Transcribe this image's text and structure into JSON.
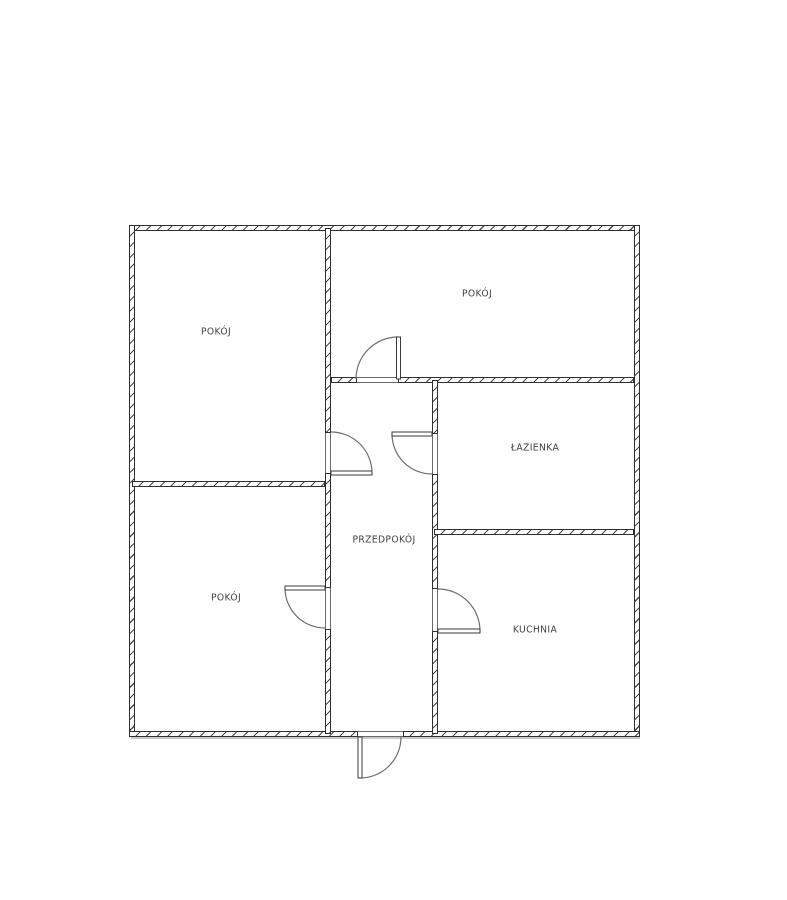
{
  "plan": {
    "kind": "apartment-floor-plan",
    "rooms": [
      {
        "id": "pokoj-top-left",
        "label": "POKÓJ"
      },
      {
        "id": "pokoj-top-right",
        "label": "POKÓJ"
      },
      {
        "id": "lazienka",
        "label": "ŁAZIENKA"
      },
      {
        "id": "przedpokoj",
        "label": "PRZEDPOKÓJ"
      },
      {
        "id": "pokoj-bottom-left",
        "label": "POKÓJ"
      },
      {
        "id": "kuchnia",
        "label": "KUCHNIA"
      }
    ],
    "colors": {
      "background": "#ffffff",
      "wall_line": "#2f2f2f",
      "wall_hatch": "#4a4a4a",
      "door_arc": "#6f6f6f",
      "door_leaf": "#3a3a3a",
      "label_text": "#3f3f3f",
      "shadow": "#c9c9c9"
    }
  }
}
